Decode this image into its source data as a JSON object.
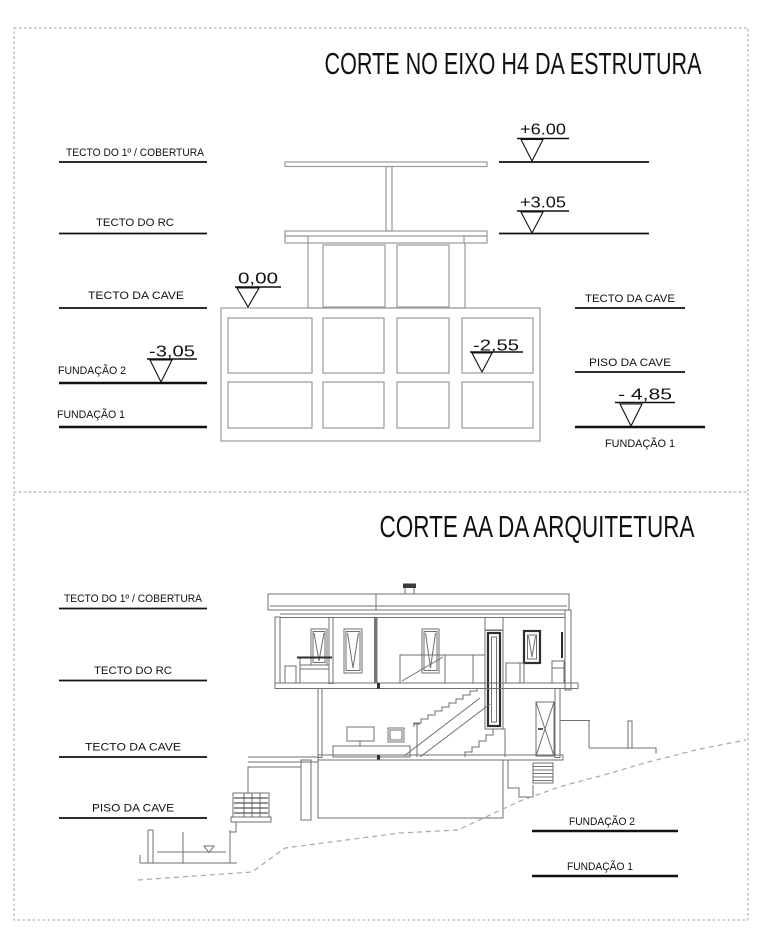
{
  "colors": {
    "background": "#ffffff",
    "structure_line": "#9a9a9a",
    "house_line": "#6f6f6f",
    "accent_dark": "#2e2e2e",
    "text": "#111111",
    "terrain_dash": "#a8a8a8",
    "panel_border": "#9f9f9f"
  },
  "titles": {
    "structure": "CORTE NO EIXO H4 DA ESTRUTURA",
    "architecture": "CORTE AA DA ARQUITETURA"
  },
  "structure_section": {
    "left_labels": [
      {
        "label": "TECTO DO 1º / COBERTURA"
      },
      {
        "label": "TECTO DO RC"
      },
      {
        "label": "TECTO DA CAVE"
      },
      {
        "label": "FUNDAÇÃO 2"
      },
      {
        "label": "FUNDAÇÃO 1"
      }
    ],
    "right_labels": [
      {
        "label": "TECTO DA CAVE"
      },
      {
        "label": "PISO DA CAVE"
      },
      {
        "label": "FUNDAÇÃO 1"
      }
    ],
    "markers": {
      "roof": "+6.00",
      "first_floor": "+3.05",
      "ground": "0,00",
      "cave_floor": "-2,55",
      "foundation2": "-3,05",
      "foundation1": "- 4,85"
    }
  },
  "architecture_section": {
    "left_labels": [
      {
        "label": "TECTO DO 1º / COBERTURA"
      },
      {
        "label": "TECTO DO RC"
      },
      {
        "label": "TECTO DA CAVE"
      },
      {
        "label": "PISO DA CAVE"
      }
    ],
    "right_labels": [
      {
        "label": "FUNDAÇÃO 2"
      },
      {
        "label": "FUNDAÇÃO 1"
      }
    ]
  }
}
